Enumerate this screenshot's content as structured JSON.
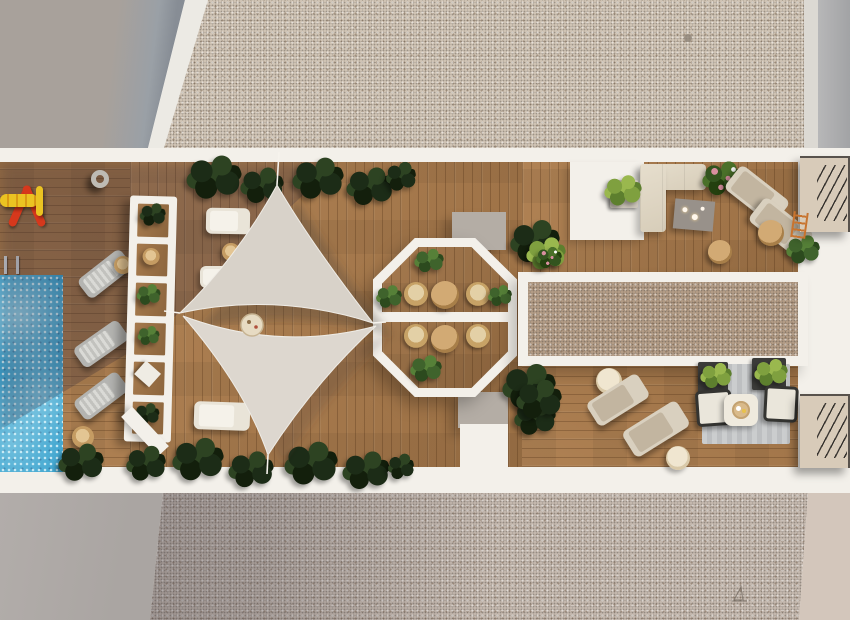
{
  "colors": {
    "white_structure": "#f3f0ea",
    "wood_base": "#b08254",
    "wood_dark": "#9a6f44",
    "pool_water": "#2f9dcb",
    "sail": "#d8d2c9",
    "gravel_top": "#cfc3b4",
    "gravel_bottom": "#c3b7ad",
    "gravel_inner": "#b29b85",
    "apron_gray": "#aaa5a2",
    "wall_top": "#a8a19b",
    "wall_top_shadow": "#878d95",
    "wall_side_right": "#a2a3a5",
    "beige_strip_right": "#d3c6bb",
    "cream_furniture": "#d7cdb9",
    "gray_table": "#98918a",
    "rug": "#bdbfc1",
    "wicker": "#c59c63",
    "stairs_wood": "#9a7048",
    "stairs_tread": "#909092",
    "landing": "#d8cbb9",
    "plant_dark": "#1c2c17",
    "plant_light": "#7fa03f",
    "flower_pink": "#d98fa0",
    "float_yellow": "#ebc322",
    "float_red": "#d6381c"
  },
  "scene": {
    "view": "top-down rooftop terrace render",
    "object_counts": {
      "pool": 1,
      "pool_float_toy": 1,
      "life_ring": 1,
      "shade_sails": 2,
      "sun_loungers": 10,
      "octagon_dining_tables": 2,
      "octagon_dining_chairs": 4,
      "corner_sofa": 1,
      "armchairs": 2,
      "side_tables": 7,
      "gravel_patio": 1,
      "trellis_pergola": 1,
      "stair_landings": 2
    }
  }
}
